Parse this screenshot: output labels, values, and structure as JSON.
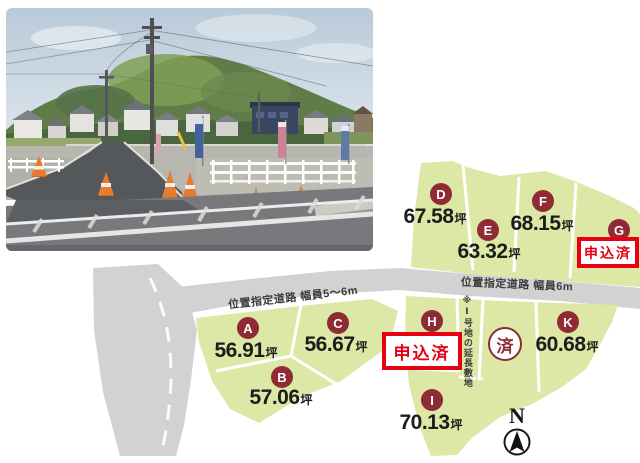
{
  "map": {
    "roads": {
      "left_label": "位置指定道路 幅員5〜6m",
      "right_label": "位置指定道路 幅員6m"
    },
    "note_extension": "※Ⅰ号地の延長敷地",
    "sold_mark": "済",
    "compass_label": "N",
    "plots": {
      "A": {
        "id": "A",
        "size": "56.91",
        "unit": "坪"
      },
      "B": {
        "id": "B",
        "size": "57.06",
        "unit": "坪"
      },
      "C": {
        "id": "C",
        "size": "56.67",
        "unit": "坪"
      },
      "D": {
        "id": "D",
        "size": "67.58",
        "unit": "坪"
      },
      "E": {
        "id": "E",
        "size": "63.32",
        "unit": "坪"
      },
      "F": {
        "id": "F",
        "size": "68.15",
        "unit": "坪"
      },
      "G": {
        "id": "G",
        "status": "申込済"
      },
      "H": {
        "id": "H",
        "status": "申込済"
      },
      "I": {
        "id": "I",
        "size": "70.13",
        "unit": "坪"
      },
      "K": {
        "id": "K",
        "size": "60.68",
        "unit": "坪"
      }
    }
  },
  "colors": {
    "plot-fill": "#dde7a6",
    "road-fill": "#d2d2d2",
    "badge-bg": "#8e2b35",
    "accent-red": "#e60012",
    "ink": "#1c1c1c"
  }
}
